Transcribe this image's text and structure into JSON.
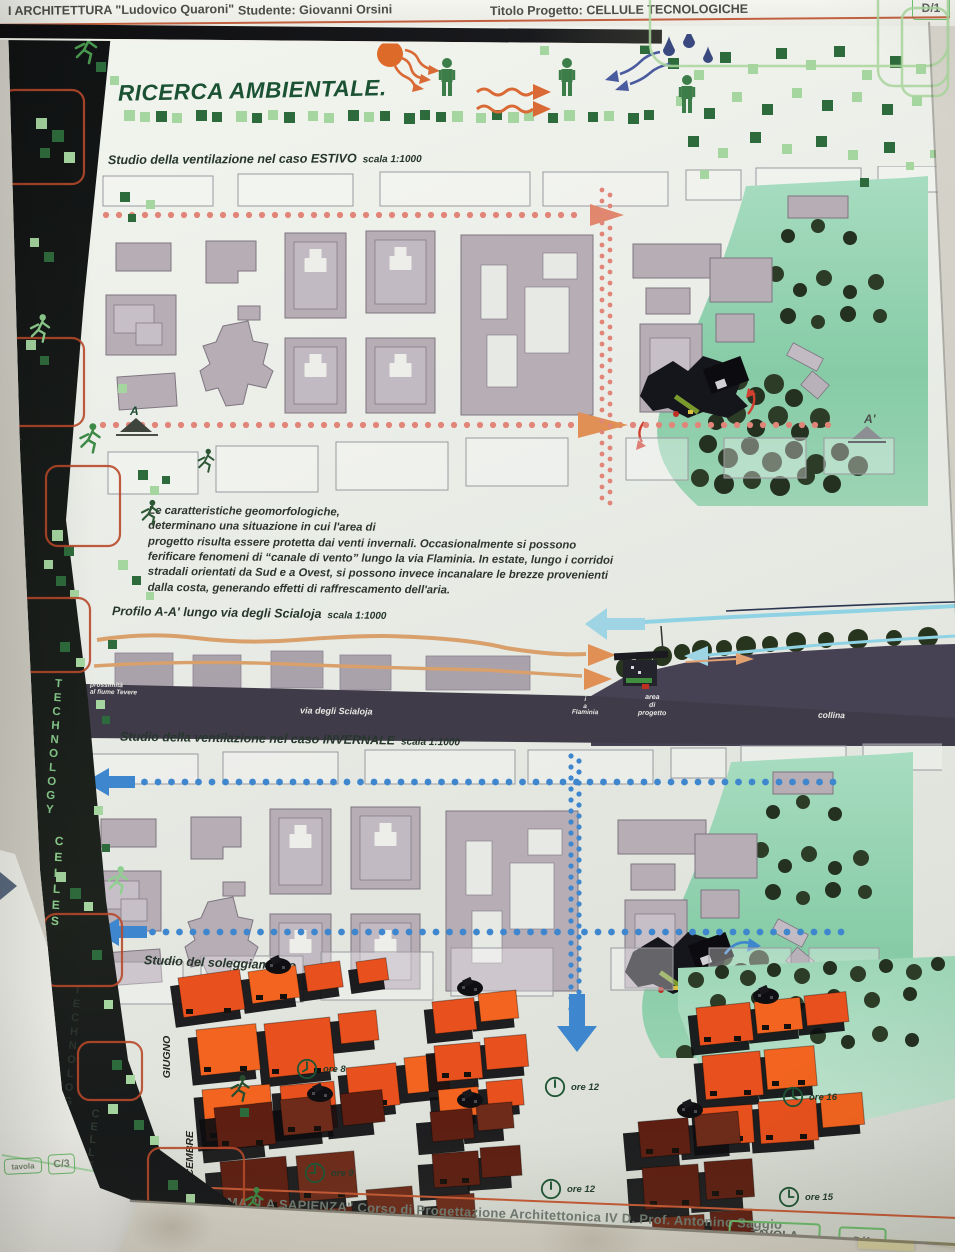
{
  "top_header": {
    "faculty": "I ARCHITETTURA \"Ludovico Quaroni\"",
    "student": "Studente: Giovanni Orsini",
    "project": "Titolo Progetto: CELLULE TECNOLOGICHE",
    "sheet_badge": "D/1"
  },
  "poster": {
    "title": "RICERCA AMBIENTALE.",
    "sidebar": {
      "word_technology": "TECHNOLOGY",
      "word_celles": "CELLES"
    },
    "estivo": {
      "heading": "Studio della ventilazione nel caso ESTIVO",
      "scale": "scala 1:1000",
      "marker_a": "A",
      "marker_a_prime": "A'"
    },
    "paragraph": "Le caratteristiche geomorfologiche,\ndeterminano una situazione in cui l'area di\nprogetto risulta essere protetta dai venti invernali. Occasionalmente si possono\nferificare fenomeni di “canale di vento” lungo la via Flaminia. In estate, lungo i corridoi\nstradali orientati da Sud e a Ovest, si possono invece incanalare le brezze provenienti\ndalla costa, generando effetti di raffrescamento dell'aria.",
    "profilo": {
      "heading": "Profilo A-A' lungo via degli Scialoja",
      "scale": "scala 1:1000",
      "label_tevere": "prossimità\nal fiume Tevere",
      "label_scialoja": "via degli Scialoja",
      "label_flaminia": "v\ni\na\nFlaminia",
      "label_area": "area\ndi\nprogetto",
      "label_collina": "collina"
    },
    "invernale": {
      "heading": "Studio della ventilazione nel caso INVERNALE",
      "scale": "scala 1:1000"
    },
    "soleggiamento": {
      "heading": "Studio del soleggiamento",
      "rows": [
        {
          "month": "GIUGNO",
          "times": [
            "ore 8",
            "ore 12",
            "ore 16"
          ]
        },
        {
          "month": "DICEMBRE",
          "times": [
            "ore 9",
            "ore 12",
            "ore 15"
          ]
        }
      ]
    },
    "footer": {
      "line1": "UNIVERSITA' DI ROMA \"LA SAPIENZA\"   Corso di Progettazione Architettonica IV D. Prof. Antonino Saggio",
      "line2": "DI ARCHITETTURA \"Ludovico Quaroni\"  Studente: Giovanni Orsini  Titolo Progetto: Cellule Tecnologiche  Moduli Impianti  Modulo di Tecnologia",
      "tavola_label": "TAVOLA",
      "tavola_number": "D/1"
    }
  },
  "under_poster": {
    "tavola_label": "tavola",
    "tavola_number": "C/3"
  },
  "colors": {
    "accent_orange": "#c85a35",
    "dot_salmon": "#e18579",
    "dot_blue": "#3e86cd",
    "square_light": "#a6d6a0",
    "square_dark": "#2e6b3c",
    "title_green": "#1b5233",
    "june_orange": "#e8511d",
    "december_brown": "#5e1f12",
    "park_green": "#8ccfa8",
    "building_gray": "#b6adb5"
  }
}
